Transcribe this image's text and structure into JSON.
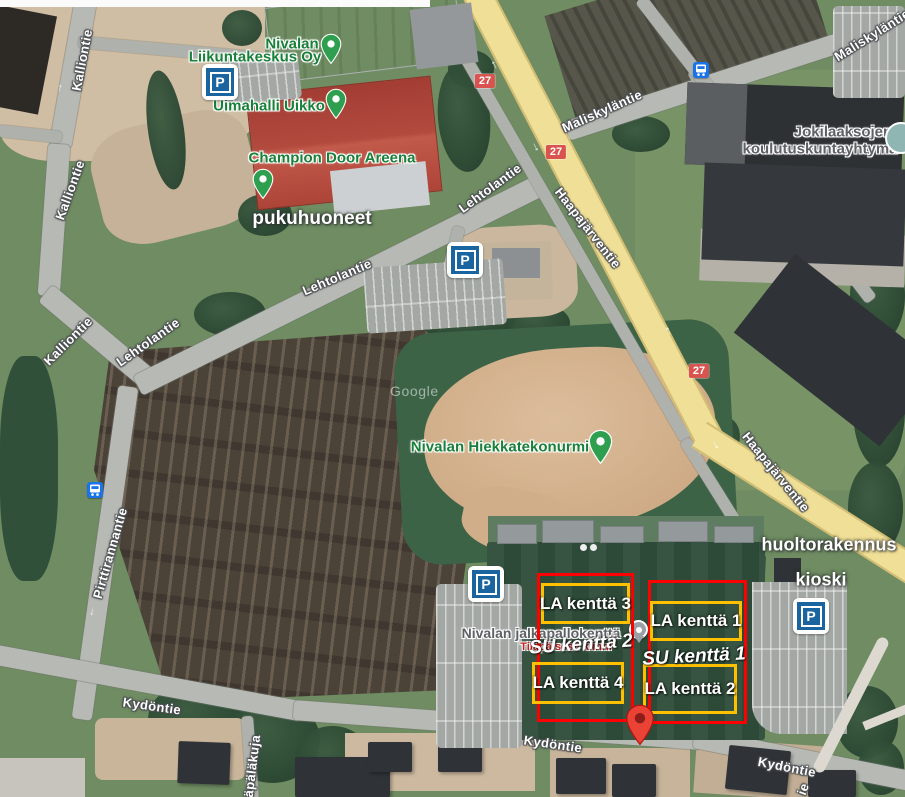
{
  "map": {
    "watermark": "Google"
  },
  "roads": {
    "kalliontie": "Kalliontie",
    "lehtolantie": "Lehtolantie",
    "maliskylantie": "Maliskyläntie",
    "haapajarventie": "Haapajärventie",
    "pirttirannantie": "Pirttirannantie",
    "kydontie": "Kydöntie",
    "apalakuja": "äpäläkuja",
    "ie_fragment": "ie"
  },
  "route_badge": "27",
  "pois": {
    "liikuntakeskus_line1": "Nivalan",
    "liikuntakeskus_line2": "Liikuntakeskus Oy",
    "uimahalli": "Uimahalli Uikko",
    "champion": "Champion Door Areena",
    "hiekkatekonurmi": "Nivalan Hiekkatekonurmi",
    "jalkapallokentta": "Nivalan jalkapallokenttä",
    "jalkapallokentta_status": "Tilapäisesti kiinni",
    "koulutus_line1": "Jokilaaksojen",
    "koulutus_line2": "koulutuskuntayhtymä"
  },
  "annotations": {
    "pukuhuoneet": "pukuhuoneet",
    "huoltorakennus": "huoltorakennus",
    "kioski": "kioski"
  },
  "fields": {
    "la1": "LA kenttä 1",
    "la2": "LA kenttä 2",
    "la3": "LA kenttä 3",
    "la4": "LA kenttä 4",
    "su1": "SU kenttä 1",
    "su2": "SU kenttä 2"
  },
  "icons": {
    "parking_glyph": "P",
    "bus": "bus-icon",
    "poi_pin": "green-map-pin",
    "dropped_pin": "red-map-pin",
    "closed_poi_pin": "gray-map-pin",
    "school_poi": "teal-poi-circle"
  },
  "colors": {
    "overlay_red": "#ff0000",
    "overlay_yellow": "#ffc000",
    "poi_green": "#188038",
    "poi_gray": "#5d6064",
    "closed_red": "#c5221f",
    "badge_red": "#d9534f",
    "parking_blue": "#1a649f",
    "bus_blue": "#1a73e8",
    "pin_green": "#2e9e4f",
    "pin_red": "#ea4335",
    "highway_yellow": "#f0df96",
    "road_gray": "#b7b9b4"
  }
}
